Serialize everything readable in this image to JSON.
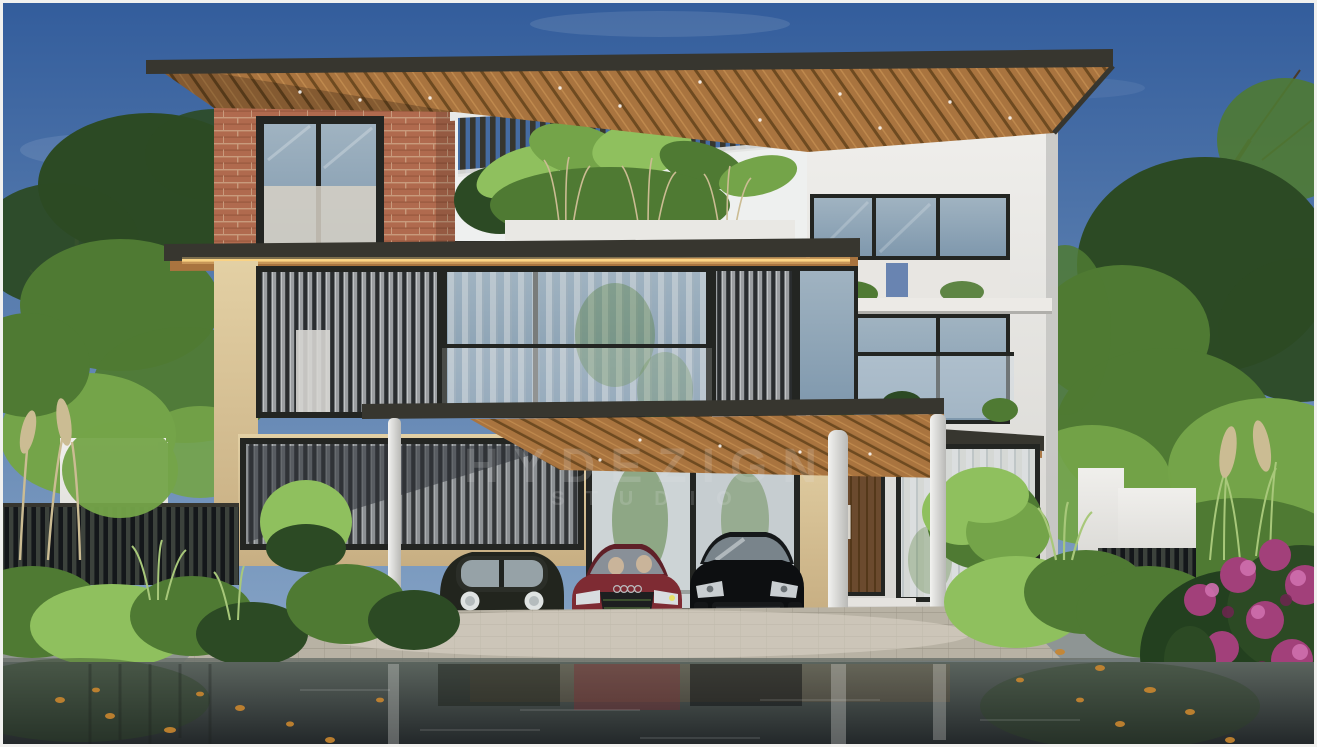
{
  "image": {
    "type": "architectural-exterior-rendering",
    "subject": "Modern three-storey tropical villa, front elevation, carport with three cars, lush landscaping, wet reflective driveway",
    "time_of_day": "day"
  },
  "watermark": {
    "line1": "HYDEZIGN",
    "line2": "STUDIO"
  },
  "cars": [
    {
      "name": "classic-compact-hatchback",
      "color_name": "black-green",
      "color": "#22251e"
    },
    {
      "name": "audi-sedan",
      "color_name": "dark-red",
      "color": "#7e2b33"
    },
    {
      "name": "porsche-cayenne-suv",
      "color_name": "black",
      "color": "#0d0f11"
    }
  ],
  "colors": {
    "sky_top": "#335d9c",
    "sky_low": "#84a2c4",
    "cloud": "#dfe8f2",
    "foliage_dark": "#2c4a24",
    "foliage_mid": "#4f7a33",
    "foliage_light": "#74a449",
    "foliage_bright": "#8fc05e",
    "grass_light": "#a8c87a",
    "plume": "#cbbc93",
    "trunk": "#4a3a28",
    "birch": "#cfc9bd",
    "fascia": "#37362f",
    "wood_light": "#c08a4e",
    "wood_mid": "#a9743f",
    "wood_dark": "#6e4a20",
    "led_glow": "#ffd887",
    "brick": "#b06a4e",
    "brick_line": "#8f5038",
    "brick_mortar": "#c89a7c",
    "travertine": "#e3d0a4",
    "travertine_dark": "#c7ae82",
    "white_wall": "#f0efec",
    "white_shade": "#d6d5d1",
    "louver_fin": "#9b9ea1",
    "louver_gap": "#2a2d2f",
    "glass": "#a0b3c1",
    "glass_dark": "#7f98ad",
    "curtain": "#dcdfe1",
    "frame_dark": "#232522",
    "door_wood": "#6b4a2e",
    "paver": "#b8b2a4",
    "curb": "#8f948f",
    "asphalt_top": "#5b645e",
    "asphalt_low": "#23282a",
    "leaf_orange": "#c9862f",
    "flower": "#a2407a",
    "flower_light": "#cf6fae",
    "flower_dark": "#6e2450",
    "column_white": "#f2f2f0",
    "watermark": "#e8e8e8"
  }
}
